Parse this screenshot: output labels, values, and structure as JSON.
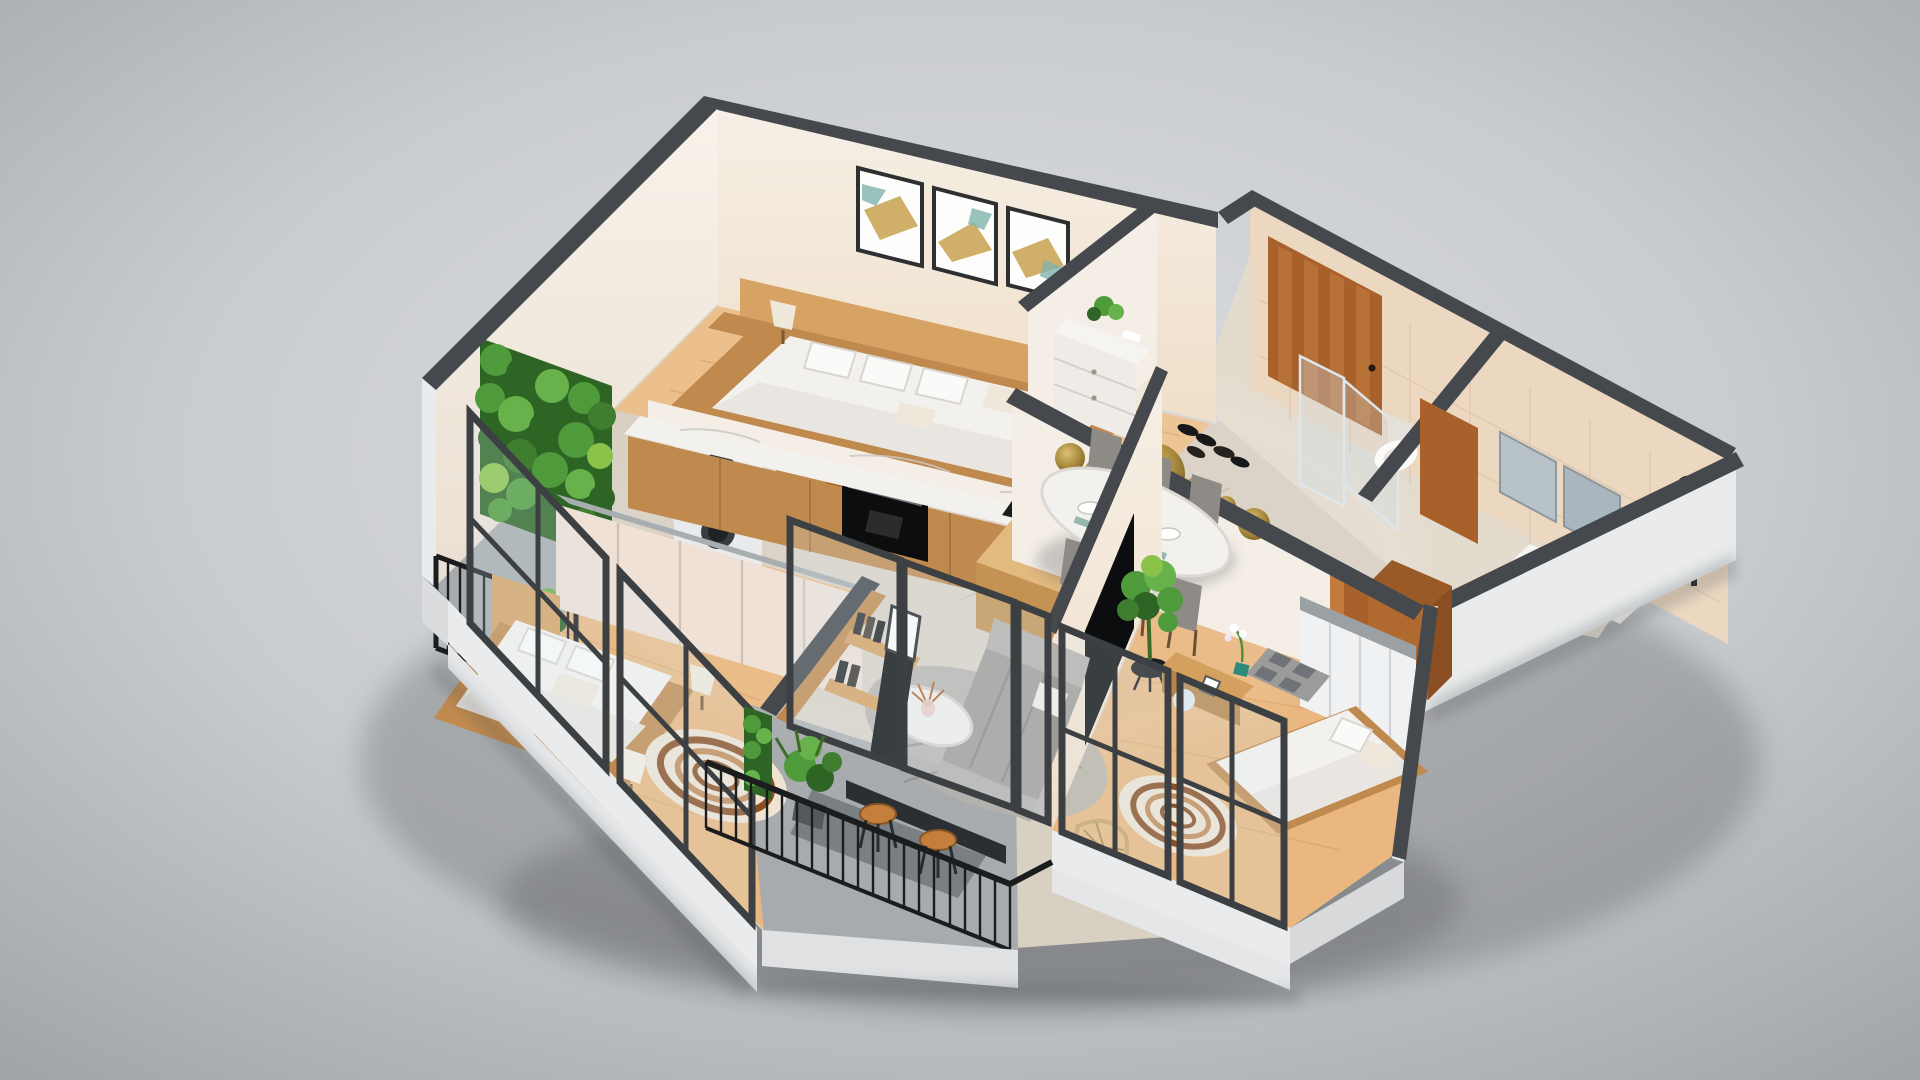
{
  "scene": {
    "title": "3D isometric cutaway floor plan of a furnished two-bathroom apartment",
    "view": "axonometric dollhouse view from above",
    "style": "photorealistic architectural visualization on a neutral gray studio background"
  },
  "colors": {
    "bgLight": "#d9dbdd",
    "bgDark": "#aaadb0",
    "cap": "#45484c",
    "wall": "#f4eee7",
    "wallShade": "#e7e0d8",
    "wallOuter": "#e9ebec",
    "tile": "#d8d0c3",
    "wingTile": "#e3dbce",
    "woodFloor": "#ecc08c",
    "woodFloor2": "#e9b77f",
    "counterWood": "#c08a4f",
    "woodDark": "#a9612b",
    "marble": "#f2f1ee",
    "balcony": "#a7abad",
    "railing": "#1a1c1e",
    "frame": "#3c4043",
    "sofa": "#a09c97",
    "chair": "#8e8b87",
    "rug": "#b4b1ad",
    "green": "#4f9a3a",
    "greenDark": "#2e6424",
    "gold": "#b3923f",
    "black": "#0c0d0e",
    "bed": "#f3f1ee",
    "bathTileWall": "#ecd7c0",
    "doormat": "#9b9b99",
    "orchid": "#c9569a"
  },
  "rooms": [
    {
      "id": "master-bedroom",
      "label": "Master Bedroom",
      "furniture": [
        "double bed with white bedding",
        "wood headboard wall",
        "three framed artworks",
        "two bedside lamps"
      ]
    },
    {
      "id": "kitchen",
      "label": "Kitchen",
      "furniture": [
        "marble countertop",
        "black undermount sink",
        "built-in black oven",
        "wood island",
        "tall cabinet",
        "interior door"
      ]
    },
    {
      "id": "laundry-balcony",
      "label": "Laundry Balcony",
      "furniture": [
        "stacked washer and dryer",
        "vertical garden green wall",
        "black metal railing",
        "service window"
      ]
    },
    {
      "id": "entry-hall",
      "label": "Entry Hall",
      "furniture": [
        "wood front door",
        "white shoe cabinet with plant",
        "pairs of shoes on floor"
      ]
    },
    {
      "id": "guest-wc",
      "label": "Guest WC",
      "furniture": [
        "toilet",
        "glass shower screen",
        "interior wood door"
      ]
    },
    {
      "id": "bathroom",
      "label": "Bathroom",
      "furniture": [
        "vanity with white basin",
        "mirror cabinets",
        "toiletry bottles",
        "dark shower column"
      ]
    },
    {
      "id": "dining-area",
      "label": "Dining Area",
      "furniture": [
        "oval marble dining table",
        "six gray upholstered chairs",
        "gold decorative wall discs",
        "place settings",
        "pink flower centerpiece"
      ]
    },
    {
      "id": "living-room",
      "label": "Living Room",
      "furniture": [
        "gray fabric sofa",
        "round marble coffee table with dried flowers",
        "gray area rug",
        "wall mounted TV",
        "fiddle-leaf fig plant",
        "wood shelving unit with books"
      ]
    },
    {
      "id": "bedroom-2",
      "label": "Bedroom 2",
      "furniture": [
        "double bed",
        "beige sliding-door wardrobe",
        "media shelf with TV",
        "concentric-circle rug",
        "white cone floor lamps",
        "full-height windows"
      ]
    },
    {
      "id": "bedroom-3",
      "label": "Bedroom 3",
      "furniture": [
        "double bed",
        "white wardrobe",
        "TV console with orchid",
        "concentric-circle rug",
        "hanging wicker chair",
        "checkered doormat",
        "full-height windows"
      ]
    },
    {
      "id": "balcony",
      "label": "Balcony",
      "furniture": [
        "black vertical-bar railing",
        "two wood bar stools",
        "dark bar counter",
        "potted plants",
        "green wall panel"
      ]
    }
  ]
}
